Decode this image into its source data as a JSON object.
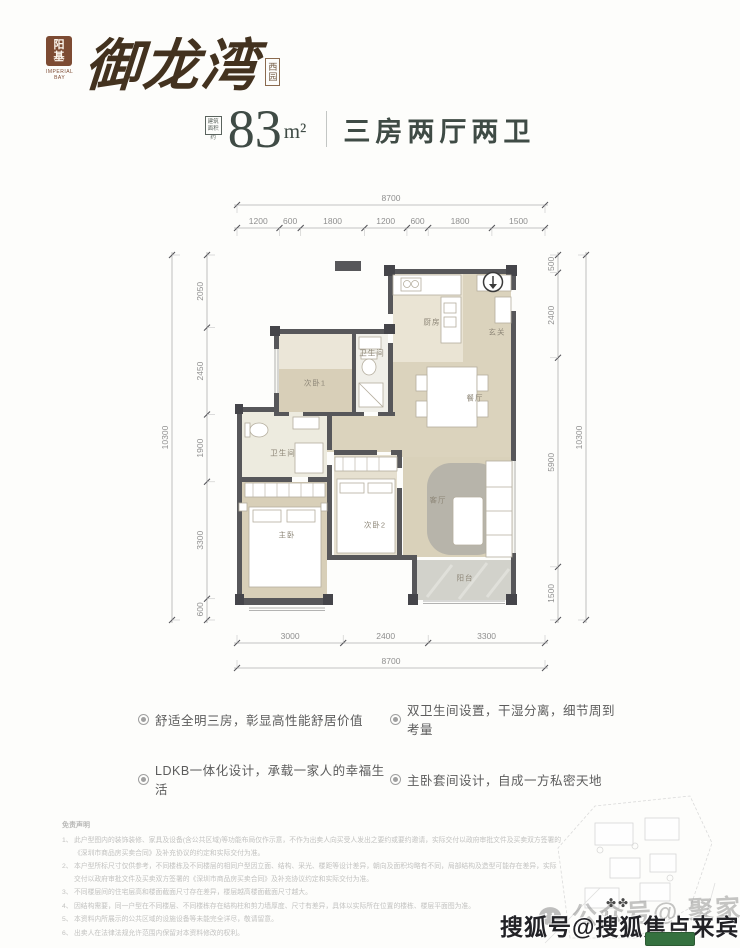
{
  "logo": {
    "seal_char1": "阳",
    "seal_char2": "基",
    "seal_caption_line1": "IMPERIAL",
    "seal_caption_line2": "BAY",
    "name": "御龙湾",
    "suffix_char1": "西",
    "suffix_char2": "园",
    "seal_color": "#7d4b33",
    "ink_color": "#43321f"
  },
  "header": {
    "area_badge_line1": "建筑",
    "area_badge_line2": "面积",
    "area_badge_line3": "约",
    "area_value": "83",
    "area_unit": "m²",
    "unit_title": "三房两厅两卫",
    "accent_color": "#3f4b45"
  },
  "floorplan": {
    "entry_arrow_icon": "down-arrow-in-circle",
    "rooms": [
      "厨房",
      "玄关",
      "卫生间",
      "次卧1",
      "餐厅",
      "卫生间",
      "主卧",
      "次卧2",
      "客厅",
      "阳台"
    ],
    "dimensions": {
      "top_total": [
        "8700"
      ],
      "top_segments": [
        "1200",
        "600",
        "1800",
        "1200",
        "600",
        "1800",
        "1500"
      ],
      "left_outer": [
        "10300"
      ],
      "left_segments": [
        "2050",
        "2450",
        "1900",
        "3300",
        "600"
      ],
      "right_segments": [
        "500",
        "2400",
        "5900",
        "1500"
      ],
      "right_outer": [
        "10300"
      ],
      "bottom_segments": [
        "3000",
        "2400",
        "3300"
      ],
      "bottom_total": [
        "8700"
      ]
    }
  },
  "features": [
    {
      "icon": "ring-bullet",
      "text": "舒适全明三房，彰显高性能舒居价值"
    },
    {
      "icon": "ring-bullet",
      "text": "双卫生间设置，干湿分离，细节周到考量"
    },
    {
      "icon": "ring-bullet",
      "text": "LDKB一体化设计，承载一家人的幸福生活"
    },
    {
      "icon": "ring-bullet",
      "text": "主卧套间设计，自成一方私密天地"
    }
  ],
  "disclaimer": {
    "title": "免责声明",
    "items": [
      "此户型图内的装饰装修、家具及设备(含公共区域)等功能布局仅作示意，不作为出卖人向买受人发出之要约或要约邀请，实际交付以政府审批文件及买卖双方签署的《深圳市商品房买卖合同》及补充协议的约定和实际交付为准。",
      "本户型所标尺寸仅供参考，不同楼栋及不同楼层的相同户型因立面、结构、采光、楼距等设计差异，朝向及面积均略有不同，局部结构及造型可能存在差异，实际交付以政府审批文件及买卖双方签署的《深圳市商品房买卖合同》及补充协议约定和实际交付为准。",
      "不同楼层间的住宅层高和楼面截面尺寸存在差异，楼层越高楼面截面尺寸越大。",
      "因结构需要，同一户型在不同楼层、不同楼栋存在结构柱和剪力墙厚度、尺寸有差异，具体以实际所在位置的楼栋、楼层平面图为准。",
      "本资料内所展示的公共区域的设施设备等未能完全详尽，敬请留意。",
      "出卖人在法律法规允许范围内保留对本资料修改的权利。"
    ]
  },
  "watermarks": {
    "wechat_account": "公众号@ 聚家好房",
    "sohu_account": "搜狐号@搜狐焦点来宾站",
    "wechat_icon": "wechat-logo"
  }
}
